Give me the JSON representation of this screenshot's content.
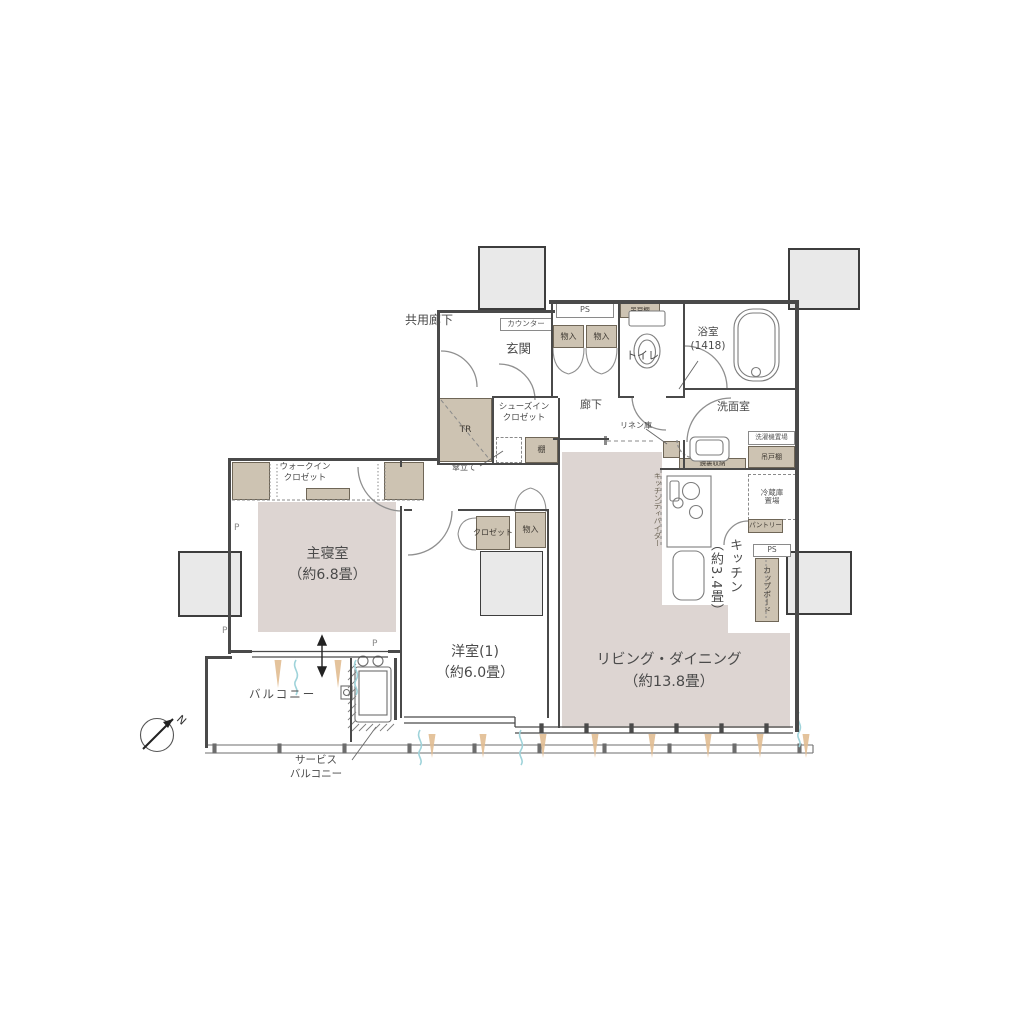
{
  "plan": {
    "outside": {
      "common_corridor": "共用廊下",
      "north": "N"
    },
    "entrance": {
      "name": "玄関",
      "counter": "カウンター",
      "trunk": "TR",
      "shoes_in_closet_1": "シューズイン",
      "shoes_in_closet_2": "クロゼット",
      "shelf": "棚",
      "umbrella_stand": "傘立て"
    },
    "hall": {
      "name": "廊下",
      "ps": "PS",
      "storage_a": "物入",
      "storage_b": "物入",
      "hanging_cupboard": "吊戸棚",
      "linen_storage": "リネン庫"
    },
    "toilet": {
      "name": "トイレ"
    },
    "bathroom": {
      "name": "浴室",
      "size": "(1418)"
    },
    "washroom": {
      "name": "洗面室",
      "washer_area": "洗濯機置場",
      "hanging_cupboard": "吊戸棚",
      "mirror_storage": "鏡裏収納"
    },
    "kitchen": {
      "name": "キッチン",
      "size": "（約3.4畳）",
      "divider": "キッチンディバイダー",
      "fridge_1": "冷蔵庫",
      "fridge_2": "置場",
      "pantry": "パントリー",
      "ps": "PS",
      "cupboard": "カップボード"
    },
    "living_dining": {
      "name": "リビング・ダイニング",
      "size": "（約13.8畳）"
    },
    "western_room": {
      "name": "洋室(1)",
      "size": "（約6.0畳）",
      "closet": "クロゼット",
      "storage": "物入"
    },
    "master_bedroom": {
      "name": "主寝室",
      "size": "（約6.8畳）",
      "wic_1": "ウォークイン",
      "wic_2": "クロゼット"
    },
    "balcony": {
      "name": "バルコニー",
      "service_1": "サービス",
      "service_2": "バルコニー"
    },
    "marks": {
      "p1": "P",
      "p2": "P",
      "p3": "P"
    }
  }
}
